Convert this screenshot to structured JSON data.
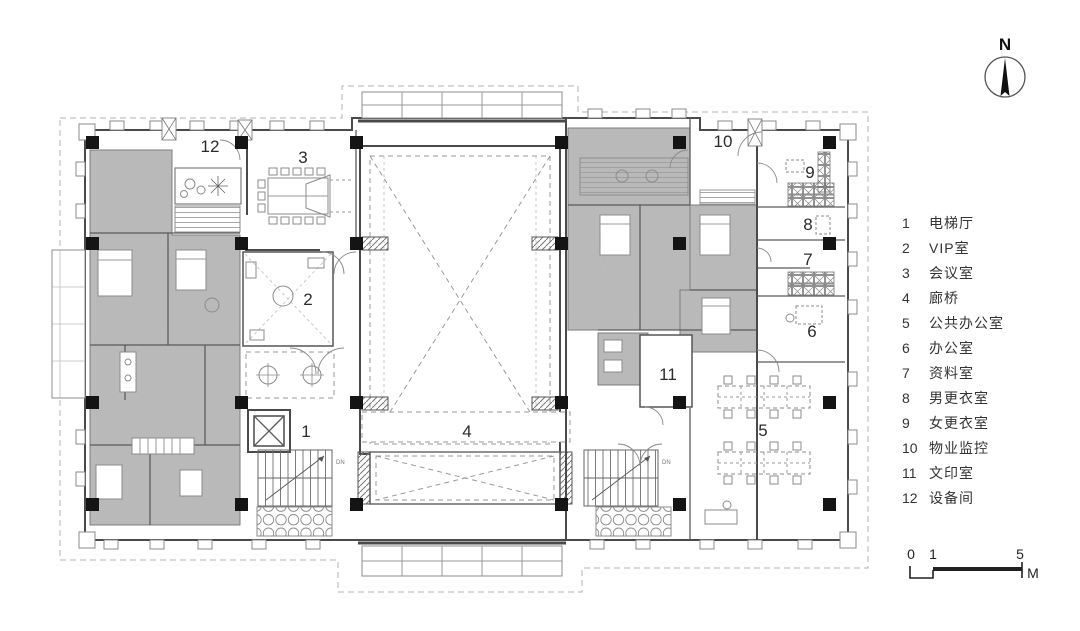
{
  "north": {
    "label": "N"
  },
  "scale_bar": {
    "tick0": "0",
    "tick1": "1",
    "tick5": "5",
    "unit": "M"
  },
  "legend": {
    "items": [
      {
        "num": "1",
        "label": "电梯厅"
      },
      {
        "num": "2",
        "label": "VIP室"
      },
      {
        "num": "3",
        "label": "会议室"
      },
      {
        "num": "4",
        "label": "廊桥"
      },
      {
        "num": "5",
        "label": "公共办公室"
      },
      {
        "num": "6",
        "label": "办公室"
      },
      {
        "num": "7",
        "label": "资料室"
      },
      {
        "num": "8",
        "label": "男更衣室"
      },
      {
        "num": "9",
        "label": "女更衣室"
      },
      {
        "num": "10",
        "label": "物业监控"
      },
      {
        "num": "11",
        "label": "文印室"
      },
      {
        "num": "12",
        "label": "设备间"
      }
    ]
  },
  "plan": {
    "stair_mark": "DN"
  },
  "colors": {
    "background": "#ffffff",
    "room_shade": "#b9b9b9",
    "wall": "#4a4a4a",
    "column": "#141414"
  }
}
